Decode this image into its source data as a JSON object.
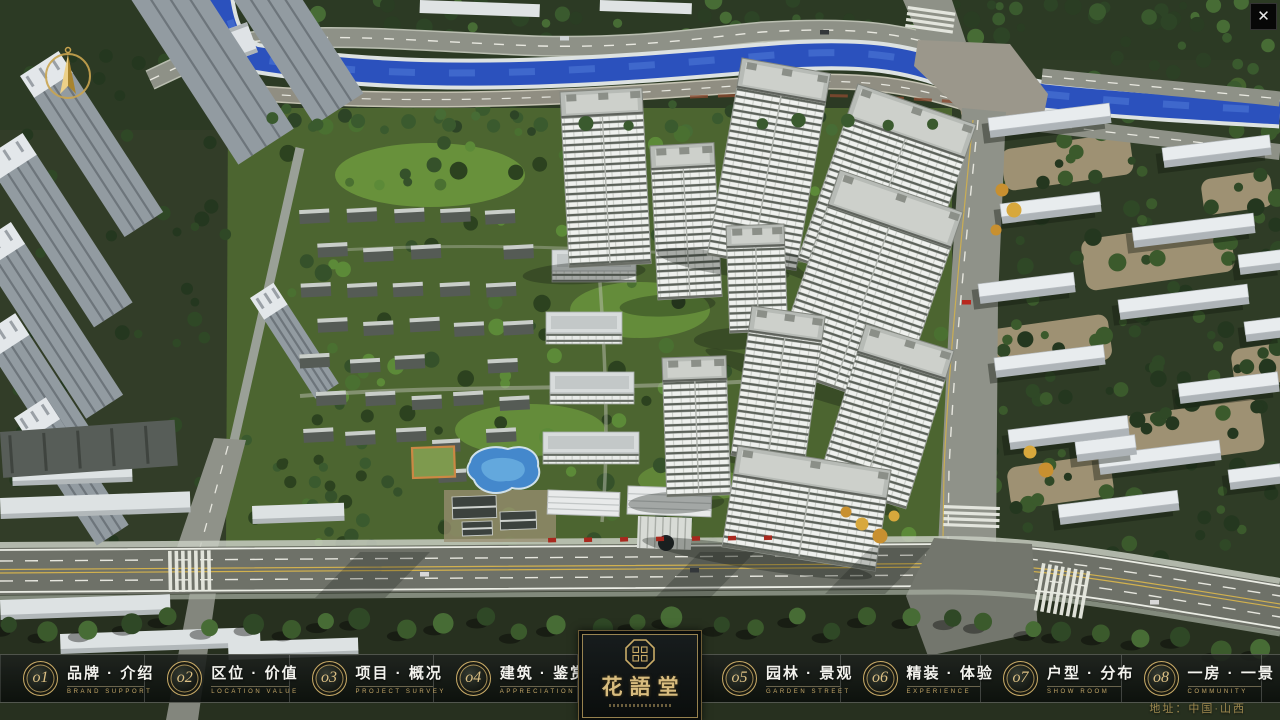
{
  "window": {
    "close_glyph": "✕"
  },
  "logo": {
    "title": "花語堂"
  },
  "nav": {
    "items": [
      {
        "num": "o1",
        "label_cn": "品牌 · 介绍",
        "label_en": "BRAND SUPPORT",
        "slug": "brand-intro"
      },
      {
        "num": "o2",
        "label_cn": "区位 · 价值",
        "label_en": "LOCATION VALUE",
        "slug": "location-value"
      },
      {
        "num": "o3",
        "label_cn": "项目 · 概况",
        "label_en": "PROJECT SURVEY",
        "slug": "project-overview"
      },
      {
        "num": "o4",
        "label_cn": "建筑 · 鉴赏",
        "label_en": "APPRECIATION",
        "slug": "architecture-appreciation"
      },
      {
        "num": "o5",
        "label_cn": "园林 · 景观",
        "label_en": "GARDEN STREET",
        "slug": "garden-landscape"
      },
      {
        "num": "o6",
        "label_cn": "精装 · 体验",
        "label_en": "EXPERIENCE",
        "slug": "decoration-experience"
      },
      {
        "num": "o7",
        "label_cn": "户型 · 分布",
        "label_en": "SHOW ROOM",
        "slug": "floorplan-distribution"
      },
      {
        "num": "o8",
        "label_cn": "一房 · 一景",
        "label_en": "COMMUNITY",
        "slug": "one-room-one-view"
      }
    ]
  },
  "footer": {
    "address": "地址：中国·山西"
  },
  "colors": {
    "gold": "#c9ab67",
    "river_blue": "#2b51bd",
    "lawn_green": "#5c8a38",
    "nav_bg": "rgba(16,20,17,0.88)"
  }
}
